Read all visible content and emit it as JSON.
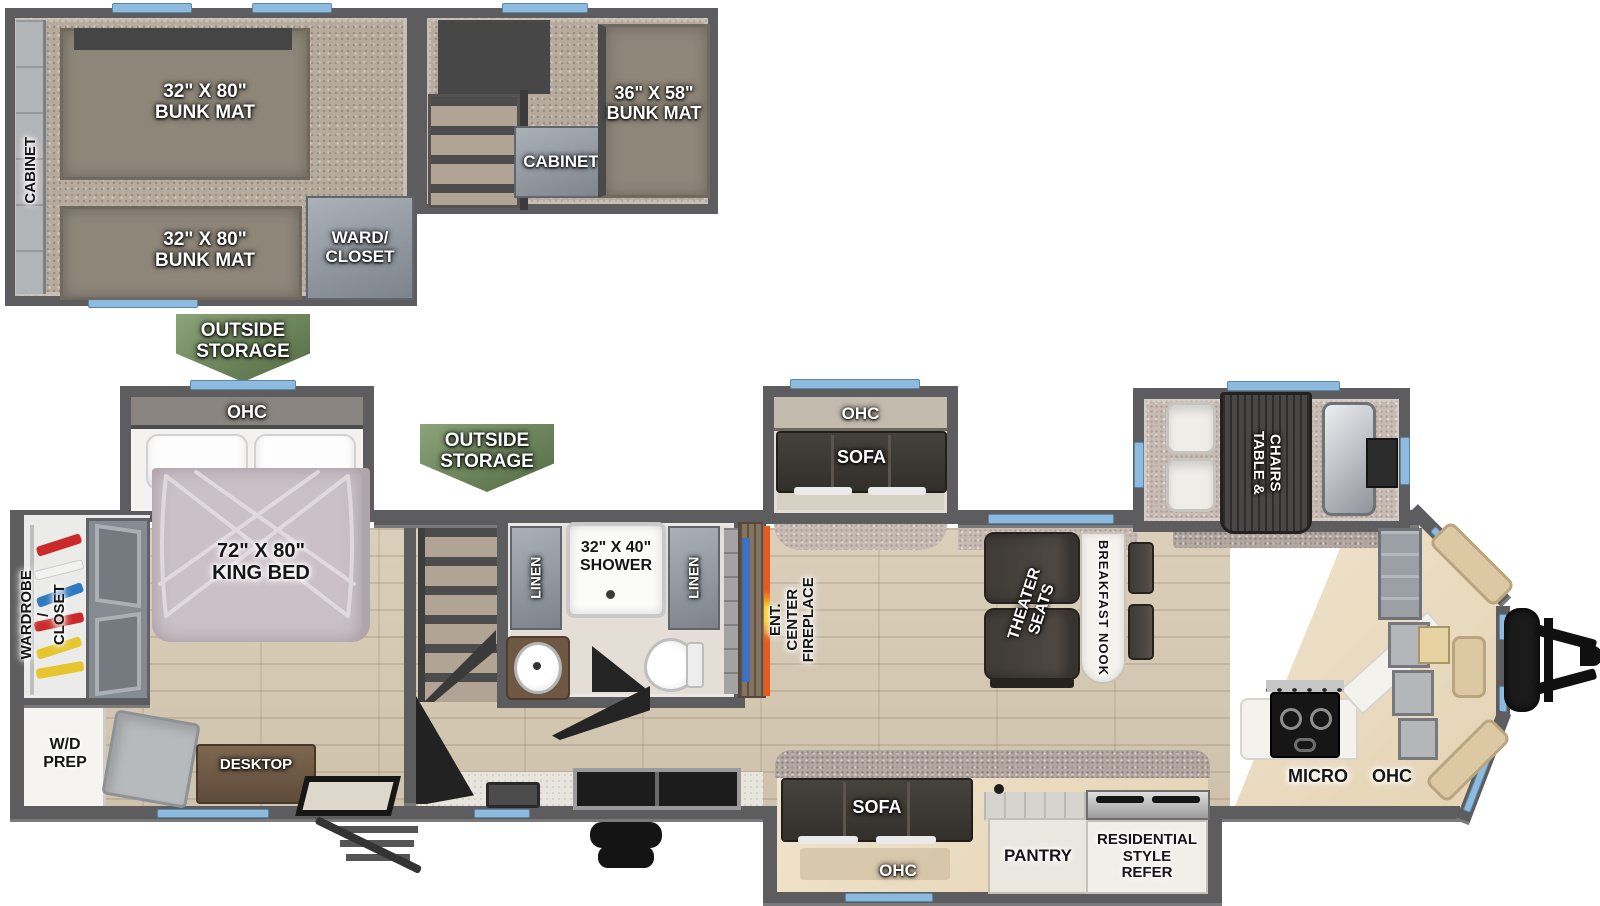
{
  "fp": {
    "colors": {
      "wall": "#5d5d5f",
      "window_blue": "#8cbbdf",
      "badge_green": "#6e8d58",
      "fireplace_orange": "#e8591d",
      "fireplace_yellow": "#f7cf1c",
      "tv_blue": "#3f6fbe"
    },
    "loft": {
      "side_cabinet_label": "CABINET",
      "bunk_top_label": "32\" X 80\"\nBUNK MAT",
      "bunk_bottom_label": "32\" X 80\"\nBUNK MAT",
      "bunk_right_label": "36\" X 58\"\nBUNK MAT",
      "cabinet_label": "CABINET",
      "ward_closet_label": "WARD/\nCLOSET"
    },
    "callouts": {
      "outside_storage_rear": "OUTSIDE\nSTORAGE",
      "outside_storage_mid": "OUTSIDE\nSTORAGE"
    },
    "bedroom": {
      "ohc_label": "OHC",
      "king_bed_label": "72\" X 80\"\nKING BED",
      "wardrobe_closet_label": "WARDROBE /\nCLOSET",
      "wd_prep_label": "W/D\nPREP",
      "desktop_label": "DESKTOP"
    },
    "bathroom": {
      "linen_left_label": "LINEN",
      "shower_label": "32\" X 40\"\nSHOWER",
      "linen_right_label": "LINEN"
    },
    "living": {
      "ent_center_label": "ENT. CENTER\nFIREPLACE",
      "sofa_slide_ohc_label": "OHC",
      "sofa_slide_label": "SOFA",
      "theater_seats_label": "THEATER\nSEATS",
      "breakfast_nook_label": "BREAKFAST NOOK",
      "dinette_label": "TABLE &\nCHAIRS"
    },
    "kitchen": {
      "rear_sofa_label": "SOFA",
      "rear_ohc_label": "OHC",
      "pantry_label": "PANTRY",
      "refer_label": "RESIDENTIAL\nSTYLE\nREFER",
      "micro_label": "MICRO",
      "ohc_label": "OHC"
    }
  }
}
